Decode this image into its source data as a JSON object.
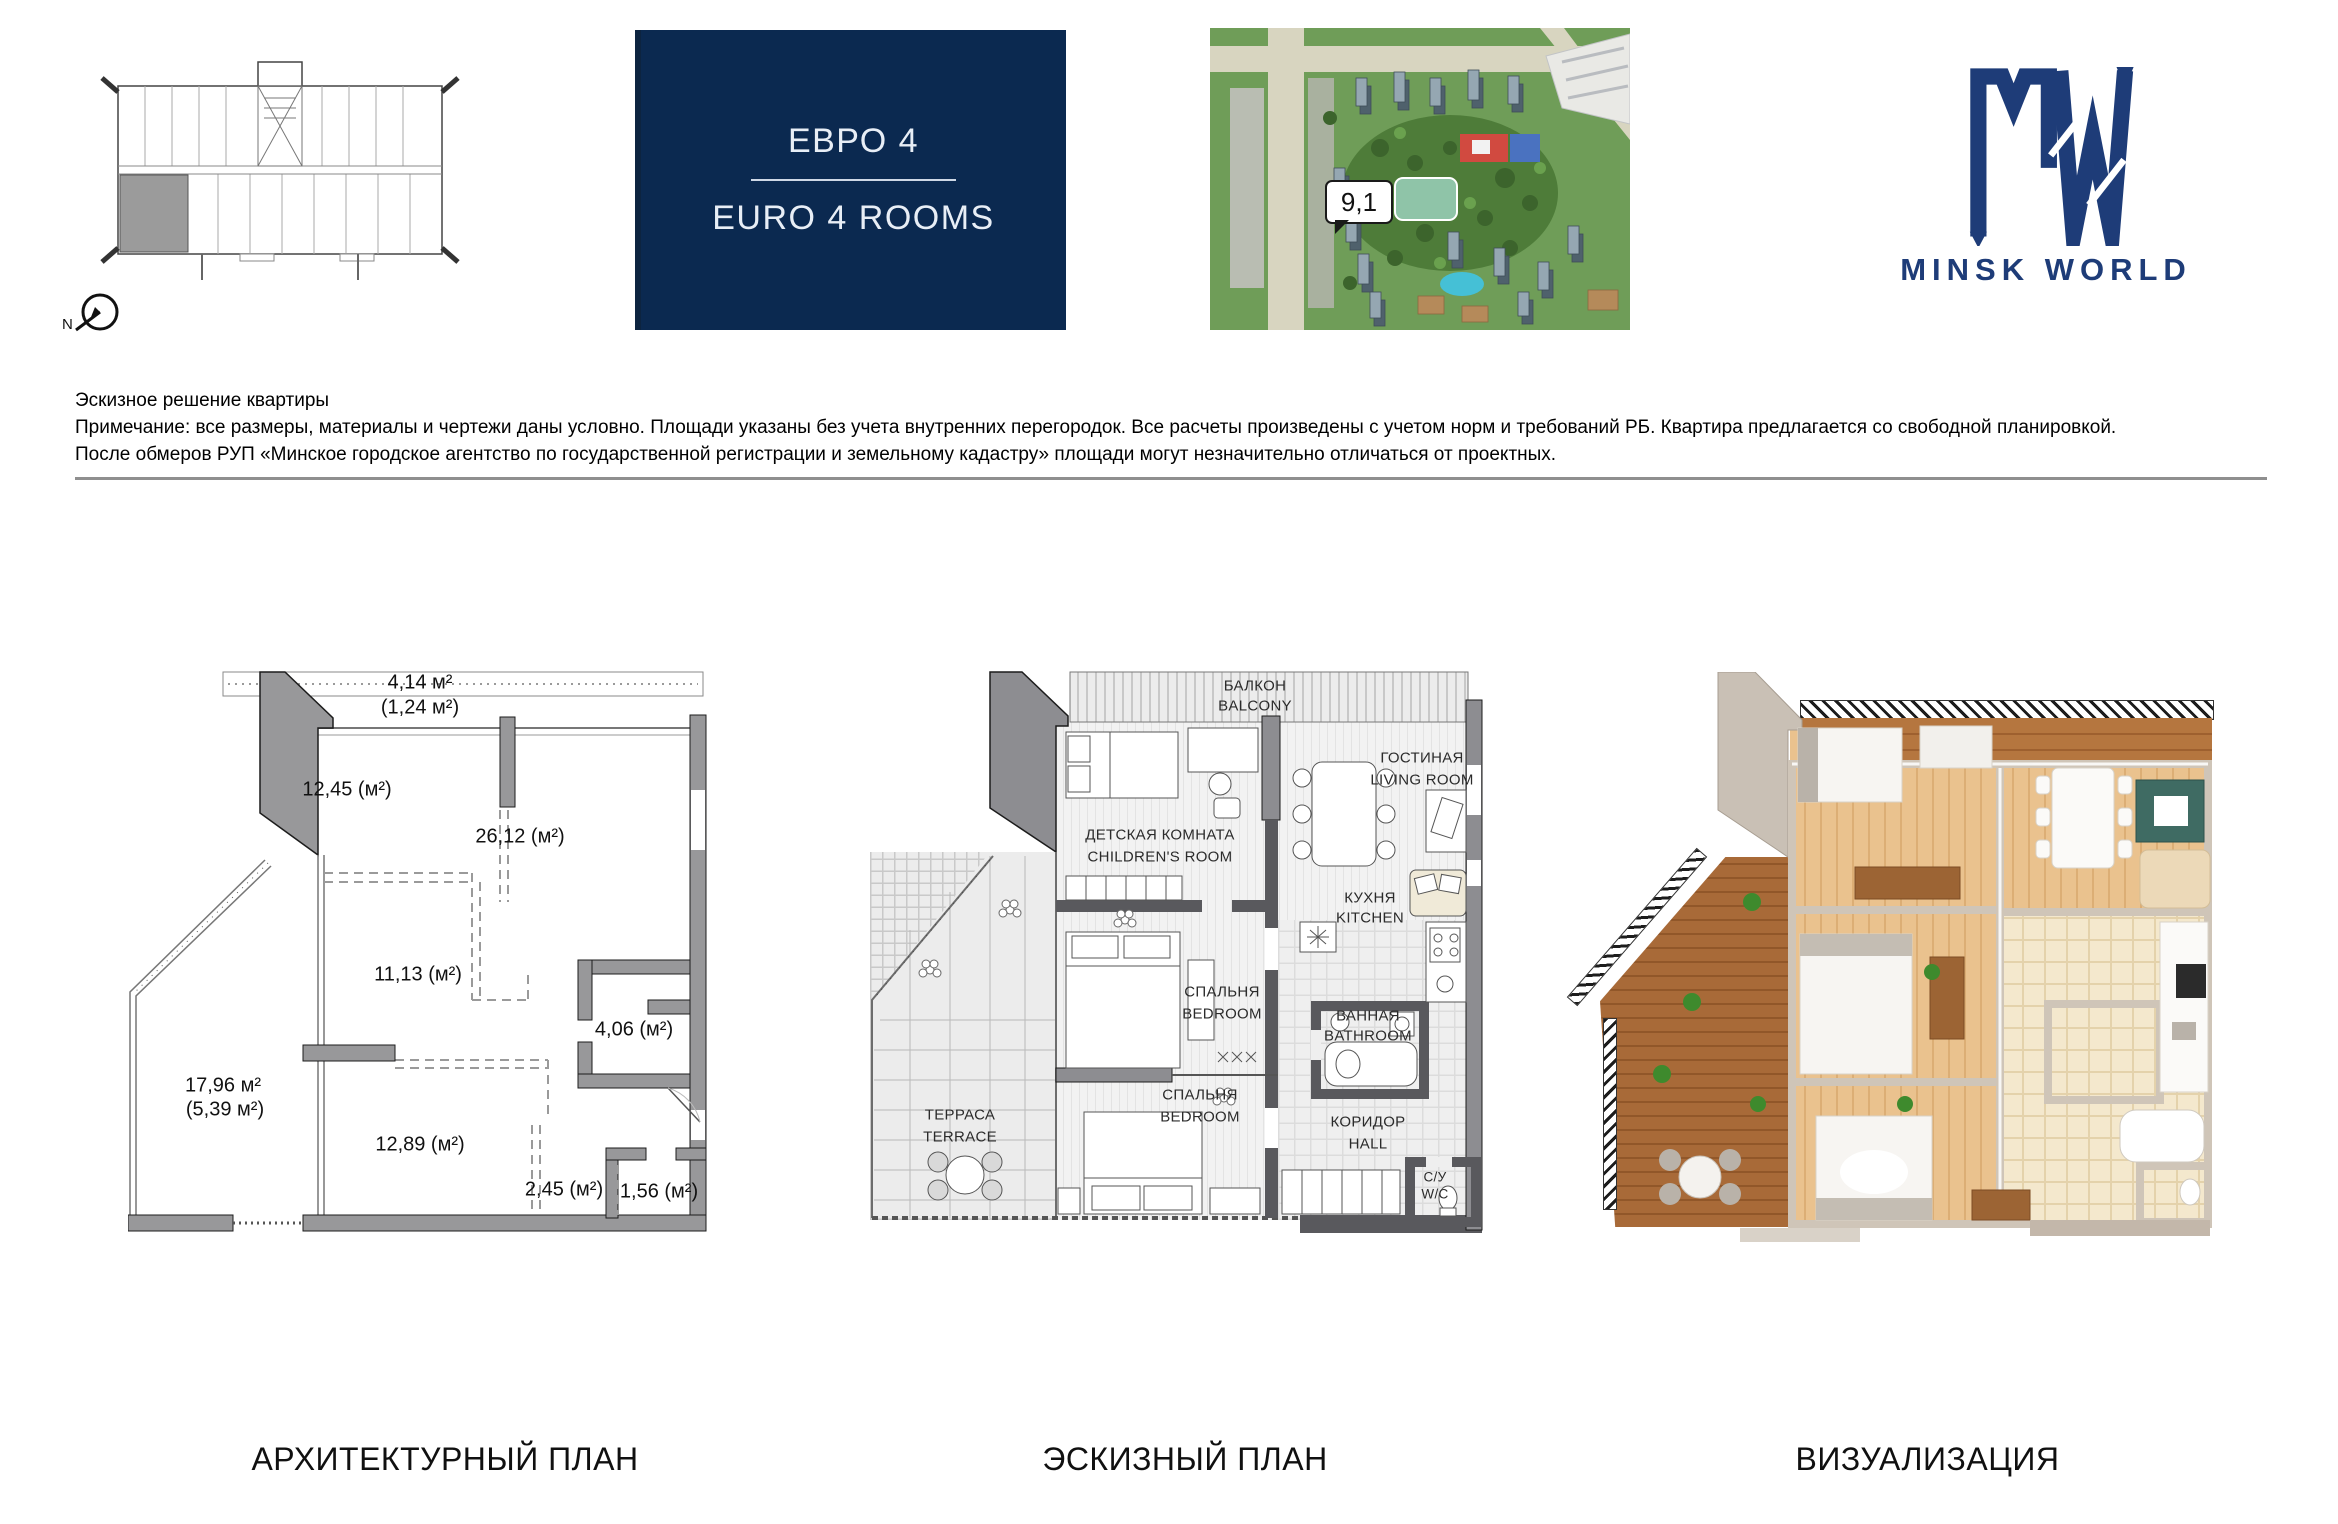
{
  "top": {
    "floor_overview": {
      "north_label": "N"
    },
    "banner": {
      "title_ru": "ЕВРО 4",
      "title_en": "EURO 4 ROOMS",
      "bg": "#0b2950",
      "text_color": "#e8eef6"
    },
    "map": {
      "callout": "9,1"
    },
    "brand": {
      "name": "MINSK WORLD",
      "color": "#1e3c78"
    }
  },
  "note": {
    "title": "Эскизное решение квартиры",
    "line1": "Примечание: все размеры, материалы и чертежи даны условно. Площади указаны без учета внутренних перегородок. Все расчеты произведены с учетом норм и требований РБ. Квартира предлагается со свободной планировкой.",
    "line2": "После обмеров РУП «Минское городское агентство по государственной регистрации и земельному кадастру» площади могут незначительно отличаться от проектных."
  },
  "plans": {
    "architectural": {
      "caption": "АРХИТЕКТУРНЫЙ ПЛАН",
      "areas": {
        "balcony_total": "4,14 м²",
        "balcony_counted": "(1,24 м²)",
        "room_a": "12,45 (м²)",
        "room_b": "26,12 (м²)",
        "room_c": "11,13 (м²)",
        "bathroom": "4,06 (м²)",
        "terrace_total": "17,96 м²",
        "terrace_counted": "(5,39 м²)",
        "room_d": "12,89 (м²)",
        "hall": "2,45 (м²)",
        "wc": "1,56 (м²)"
      }
    },
    "sketch": {
      "caption": "ЭСКИЗНЫЙ ПЛАН",
      "rooms": {
        "balcony": {
          "ru": "БАЛКОН",
          "en": "BALCONY"
        },
        "children": {
          "ru": "ДЕТСКАЯ КОМНАТА",
          "en": "CHILDREN'S ROOM"
        },
        "living": {
          "ru": "ГОСТИНАЯ",
          "en": "LIVING ROOM"
        },
        "kitchen": {
          "ru": "КУХНЯ",
          "en": "KITCHEN"
        },
        "bedroom1": {
          "ru": "СПАЛЬНЯ",
          "en": "BEDROOM"
        },
        "bathroom": {
          "ru": "ВАННАЯ",
          "en": "BATHROOM"
        },
        "terrace": {
          "ru": "ТЕРРАСА",
          "en": "TERRACE"
        },
        "bedroom2": {
          "ru": "СПАЛЬНЯ",
          "en": "BEDROOM"
        },
        "hall": {
          "ru": "КОРИДОР",
          "en": "HALL"
        },
        "wc": {
          "ru": "С/У",
          "en": "W/C"
        }
      }
    },
    "visualization": {
      "caption": "ВИЗУАЛИЗАЦИЯ"
    }
  }
}
